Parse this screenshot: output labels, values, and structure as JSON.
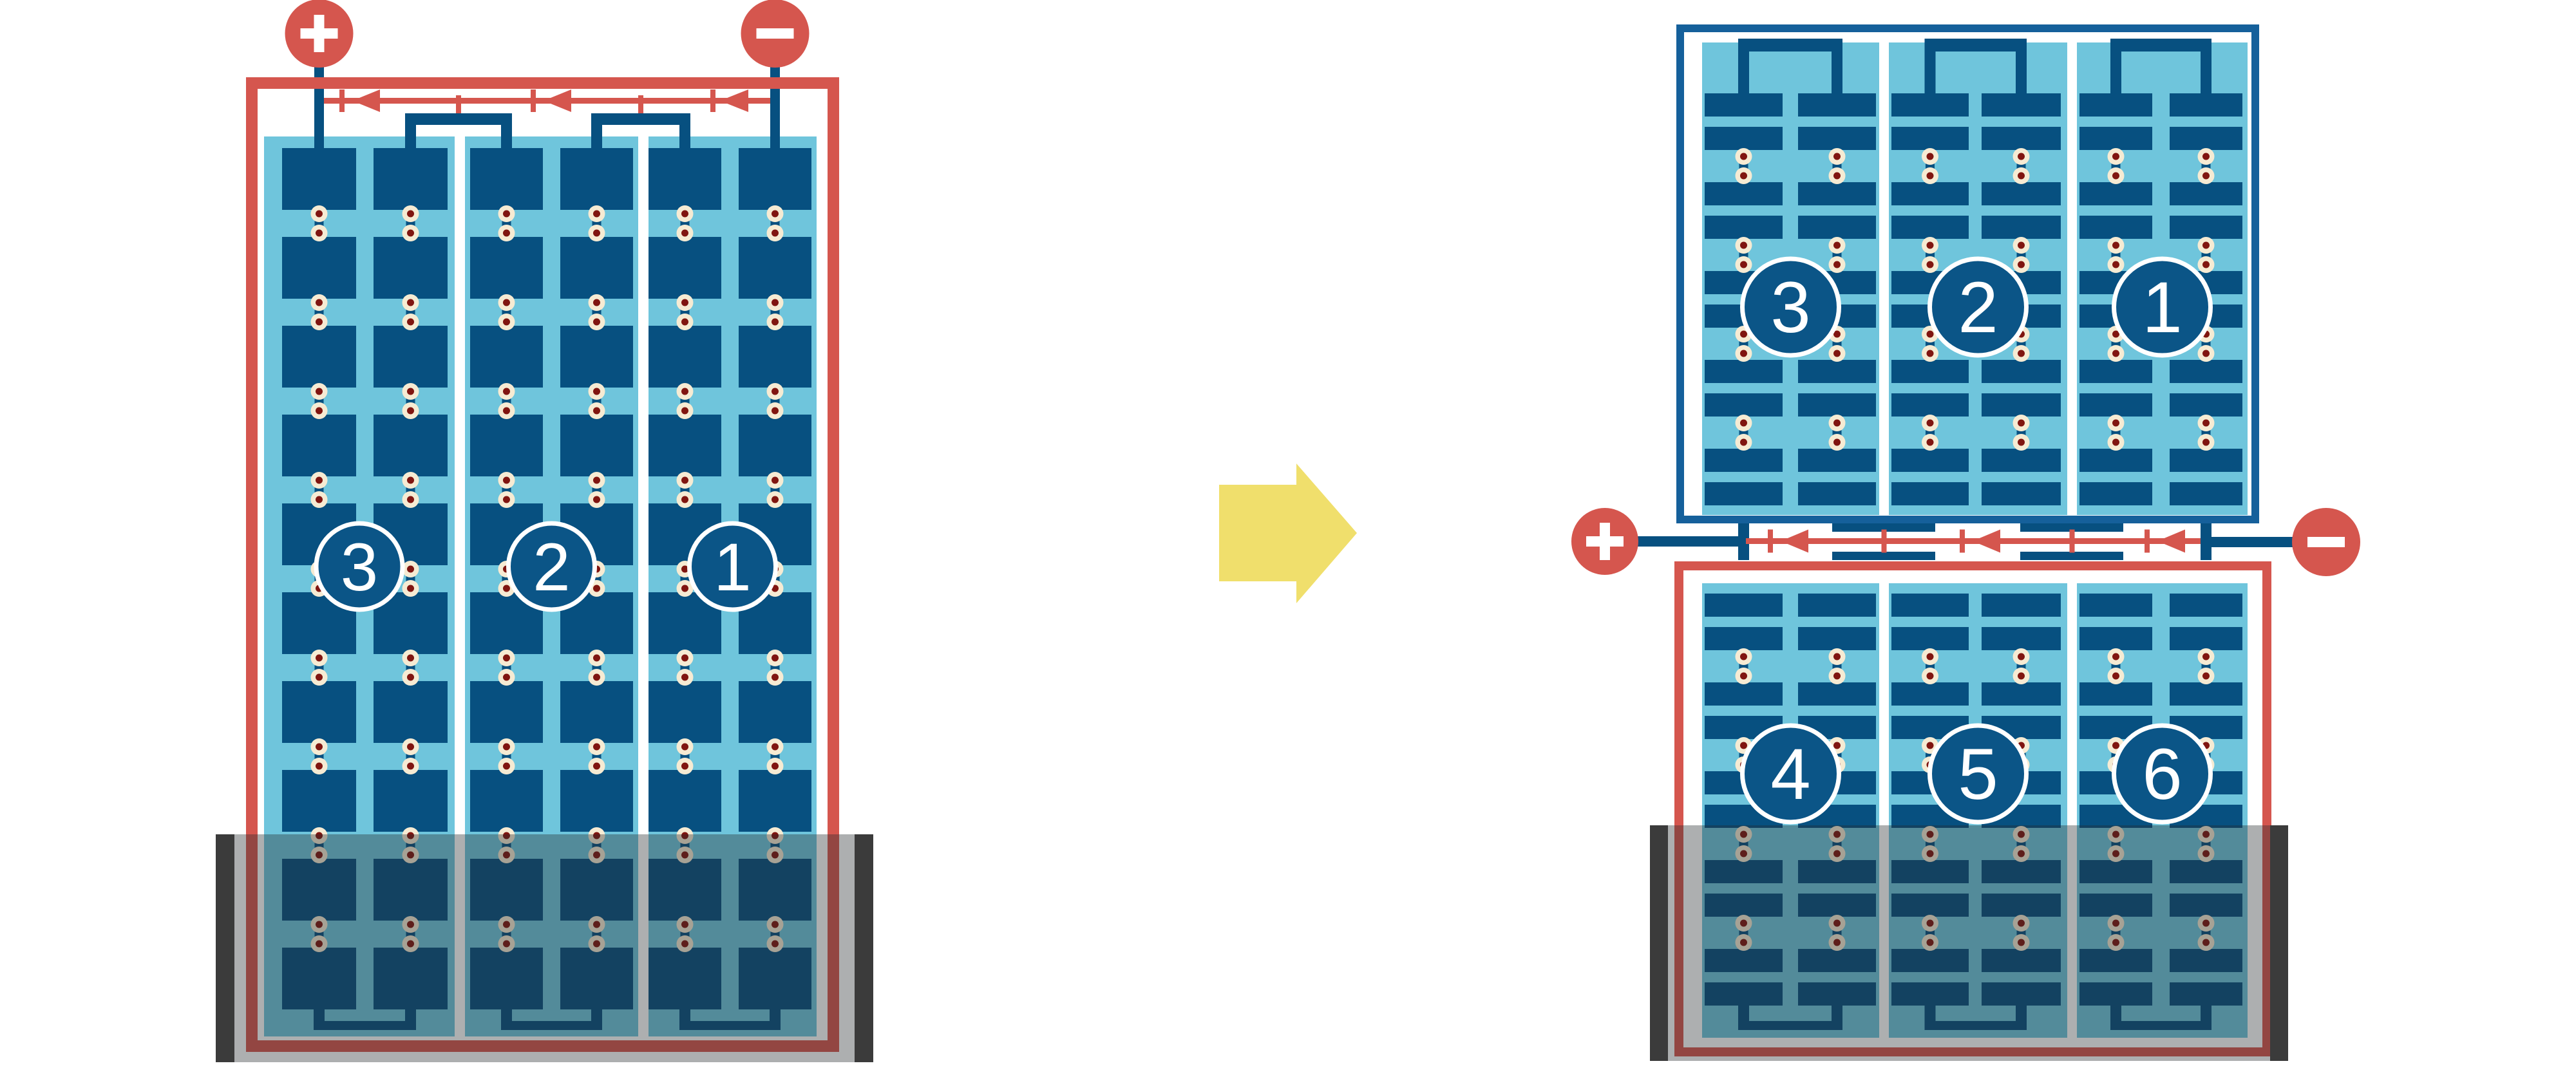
{
  "diagram_type": "solar-panel-cell-layout-comparison",
  "colors": {
    "red": "#D5564E",
    "frame_blue": "#15609B",
    "cell_blue": "#075080",
    "badge_blue": "#0B5587",
    "light_blue": "#6FC5DC",
    "solder_cream": "#F6EBD3",
    "solder_core": "#801510",
    "arrow_yellow": "#F0DF6C",
    "shade_bar": "#3B3B3B",
    "shade_overlay": "rgba(40,44,48,0.38)",
    "white": "#FFFFFF"
  },
  "left_diagram": {
    "name": "full-cell panel",
    "frame_color": "#D5564E",
    "bypass_diodes": 3,
    "rows_per_column": 10,
    "columns_per_substring": 2,
    "substrings": [
      {
        "label": "3"
      },
      {
        "label": "2"
      },
      {
        "label": "1"
      }
    ],
    "terminals": {
      "positive": {
        "symbol": "+"
      },
      "negative": {
        "symbol": "−"
      }
    },
    "shaded_bottom": true
  },
  "right_diagram": {
    "name": "half-cut panel",
    "bypass_diodes": 3,
    "rows_per_column": 10,
    "columns_per_substring": 2,
    "top_half": {
      "frame_color": "#15609B",
      "substrings": [
        {
          "label": "3"
        },
        {
          "label": "2"
        },
        {
          "label": "1"
        }
      ]
    },
    "bottom_half": {
      "frame_color": "#D5564E",
      "substrings": [
        {
          "label": "4"
        },
        {
          "label": "5"
        },
        {
          "label": "6"
        }
      ]
    },
    "terminals": {
      "positive": {
        "symbol": "+"
      },
      "negative": {
        "symbol": "−"
      }
    },
    "shaded_bottom": true
  },
  "arrow": {
    "direction": "right",
    "color": "#F0DF6C"
  }
}
